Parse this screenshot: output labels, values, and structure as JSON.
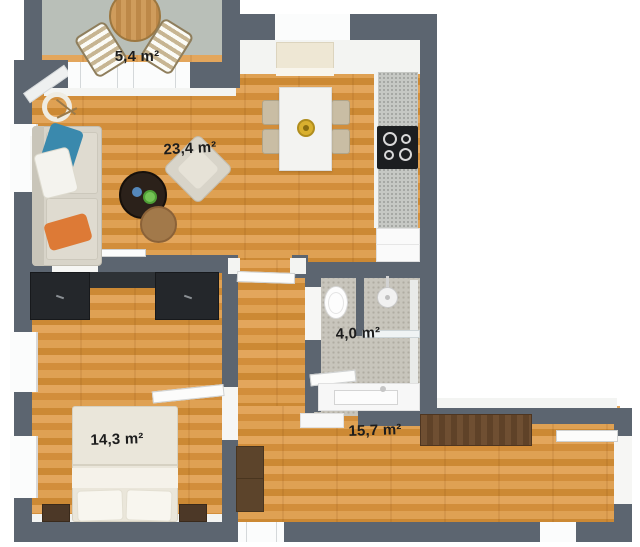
{
  "plan": {
    "rooms": [
      {
        "id": "balcony",
        "area_label": "5,4 m²"
      },
      {
        "id": "living-kitchen",
        "area_label": "23,4 m²"
      },
      {
        "id": "bathroom",
        "area_label": "4,0 m²"
      },
      {
        "id": "bedroom",
        "area_label": "14,3 m²"
      },
      {
        "id": "hallway",
        "area_label": "15,7 m²"
      }
    ]
  },
  "colors": {
    "wall": "#5c6570",
    "wood": "#d89747",
    "balcony-floor": "#b9bfb8",
    "bath-floor": "#c8c5bc",
    "label": "#1c1c1c",
    "blue": "#3a89ad",
    "orange": "#dd7a36",
    "green": "#74c455",
    "dark-furn": "#24272b",
    "wood-furn": "#6b4c30"
  }
}
